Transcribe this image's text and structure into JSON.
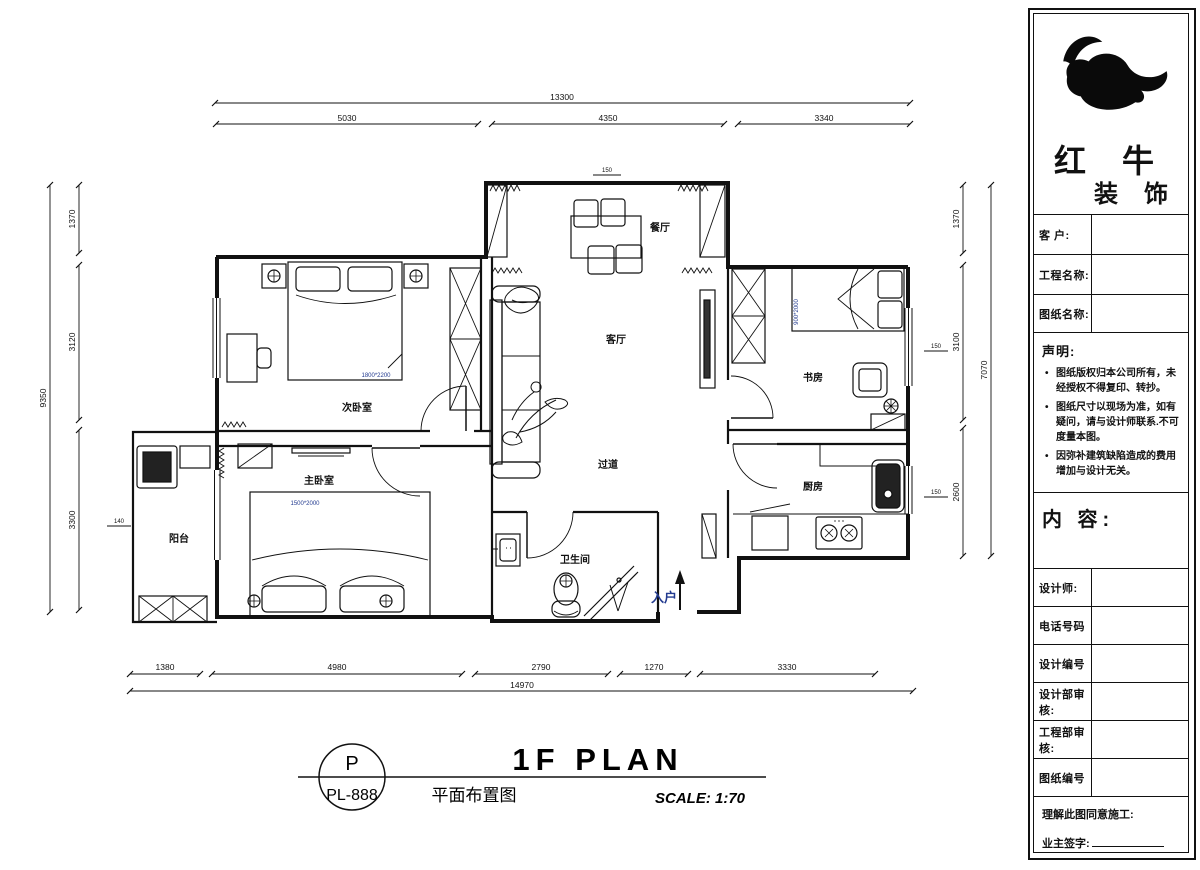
{
  "plan": {
    "rooms": {
      "dining": "餐厅",
      "living": "客厅",
      "bedroom2": "次卧室",
      "master": "主卧室",
      "balcony": "阳台",
      "corridor": "过道",
      "bathroom": "卫生间",
      "study": "书房",
      "kitchen": "厨房"
    },
    "entrance_label": "入户",
    "furniture_labels": {
      "bedroom2_bed": "1800*2200",
      "master_bed": "1500*2000",
      "study_bed": "900*2000"
    },
    "mini_dims": {
      "top": "150",
      "right_upper": "150",
      "right_lower": "150",
      "left": "140"
    }
  },
  "dims": {
    "top": {
      "overall": "13300",
      "seg1": "5030",
      "seg2": "4350",
      "seg3": "3340"
    },
    "bottom": {
      "overall": "14970",
      "seg1": "1380",
      "seg2": "4980",
      "seg3": "2790",
      "seg4": "1270",
      "seg5": "3330"
    },
    "left": {
      "overall": "9350",
      "seg1": "1370",
      "seg2": "3120",
      "seg3": "3300"
    },
    "right": {
      "overall": "7070",
      "seg1": "1370",
      "seg2": "3100",
      "seg3": "2600"
    }
  },
  "titlebar": {
    "code_top": "P",
    "code_bottom": "PL-888",
    "title_en": "1F PLAN",
    "title_cn": "平面布置图",
    "scale": "SCALE: 1:70"
  },
  "titleblock": {
    "brand1": "红 牛",
    "brand2": "装 饰",
    "customer": "客  户:",
    "project": "工程名称:",
    "drawing": "图纸名称:",
    "statement": {
      "title": "声明:",
      "items": [
        "图纸版权归本公司所有，未经授权不得复印、转抄。",
        "图纸尺寸以现场为准，如有疑问，请与设计师联系.不可度量本图。",
        "因弥补建筑缺陷造成的费用增加与设计无关。"
      ]
    },
    "content": "内 容:",
    "designer": "设计师:",
    "phone": "电话号码",
    "design_no": "设计编号",
    "design_review": "设计部审核:",
    "eng_review": "工程部审核:",
    "drawing_no": "图纸编号",
    "agree": "理解此图同意施工:",
    "owner_sign": "业主签字:"
  },
  "colors": {
    "ink": "#111111",
    "accent_blue": "#223a8f"
  }
}
